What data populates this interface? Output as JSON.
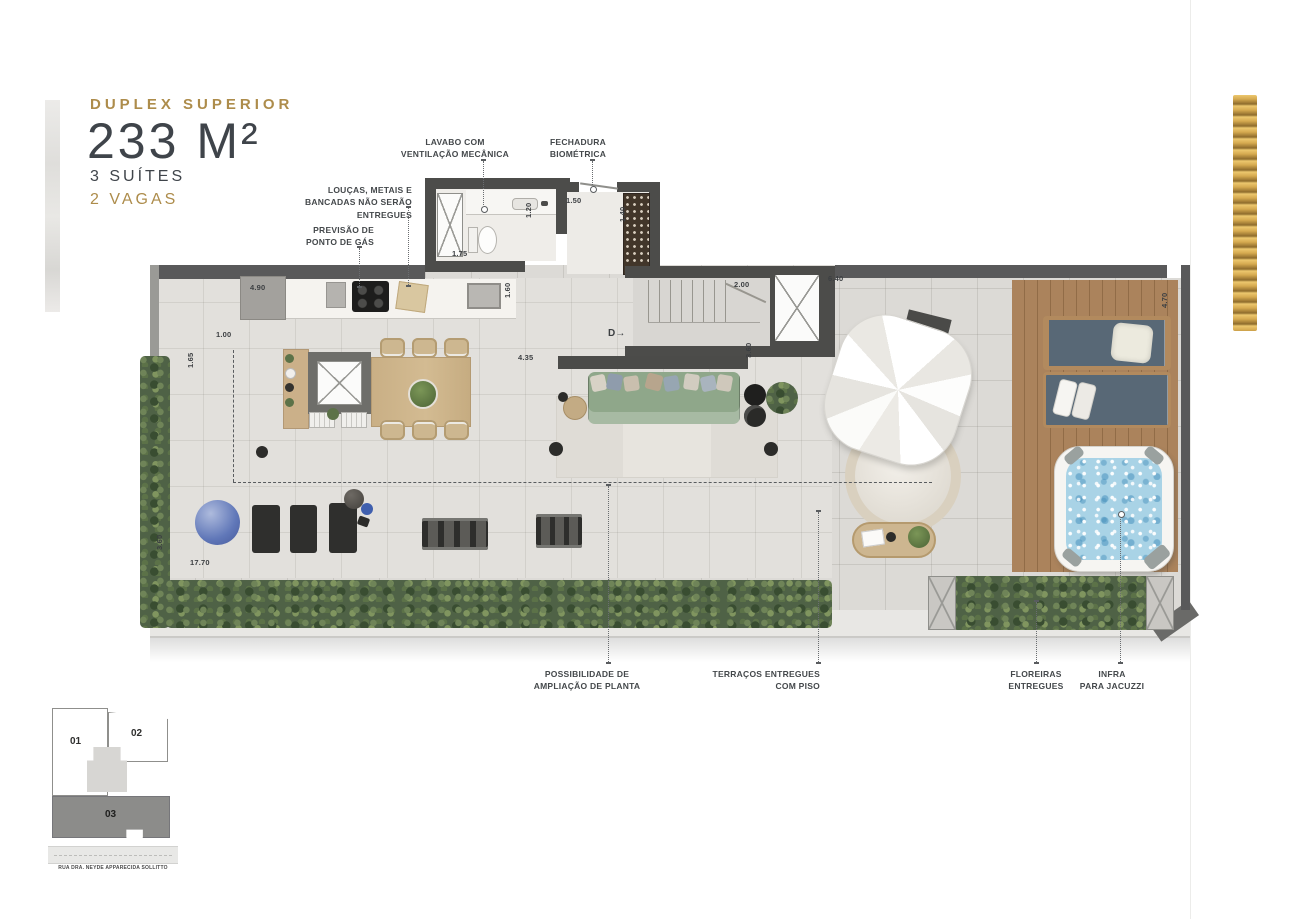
{
  "header": {
    "type_label": "DUPLEX SUPERIOR",
    "area": "233 M²",
    "suites": "3 SUÍTES",
    "parking": "2 VAGAS"
  },
  "callouts": {
    "lavabo": "LAVABO COM\nVENTILAÇÃO MECÂNICA",
    "biometric": "FECHADURA\nBIOMÉTRICA",
    "fixtures": "LOUÇAS, METAIS E\nBANCADAS NÃO SERÃO ENTREGUES",
    "gas": "PREVISÃO DE\nPONTO DE GÁS",
    "expansion": "POSSIBILIDADE DE\nAMPLIAÇÃO DE PLANTA",
    "terrace": "TERRAÇOS ENTREGUES\nCOM PISO",
    "planters": "FLOREIRAS\nENTREGUES",
    "jacuzzi": "INFRA\nPARA JACUZZI"
  },
  "dimensions": {
    "kitchen_width": "4.90",
    "kitchen_depth": "1.65",
    "side_strip": "1.00",
    "bath_width": "1.75",
    "bath_depth": "1.20",
    "entry_width": "1.50",
    "entry_depth": "1.40",
    "counter_side": "1.60",
    "stair_width": "2.00",
    "terrace_right_width": "6.40",
    "living_width": "4.35",
    "stair_hall_depth": "3.60",
    "left_terrace_depth": "3.60",
    "total_width": "17.70",
    "deck_depth": "4.70"
  },
  "plan_labels": {
    "door_direction": "D→"
  },
  "keyplan": {
    "unit_01": "01",
    "unit_02": "02",
    "unit_03": "03",
    "street": "RUA DRA. NEYDE APPARECIDA SOLLITTO"
  },
  "colors": {
    "accent_gold": "#ad8c4b",
    "text_dark": "#3f444a",
    "wall": "#59595a",
    "floor_tile": "#dcdad6",
    "wood_deck": "#a8825c",
    "water": "#a9d3e6",
    "foliage": "#4f6246",
    "lounger": "#586876",
    "sofa": "#8fa78a"
  }
}
